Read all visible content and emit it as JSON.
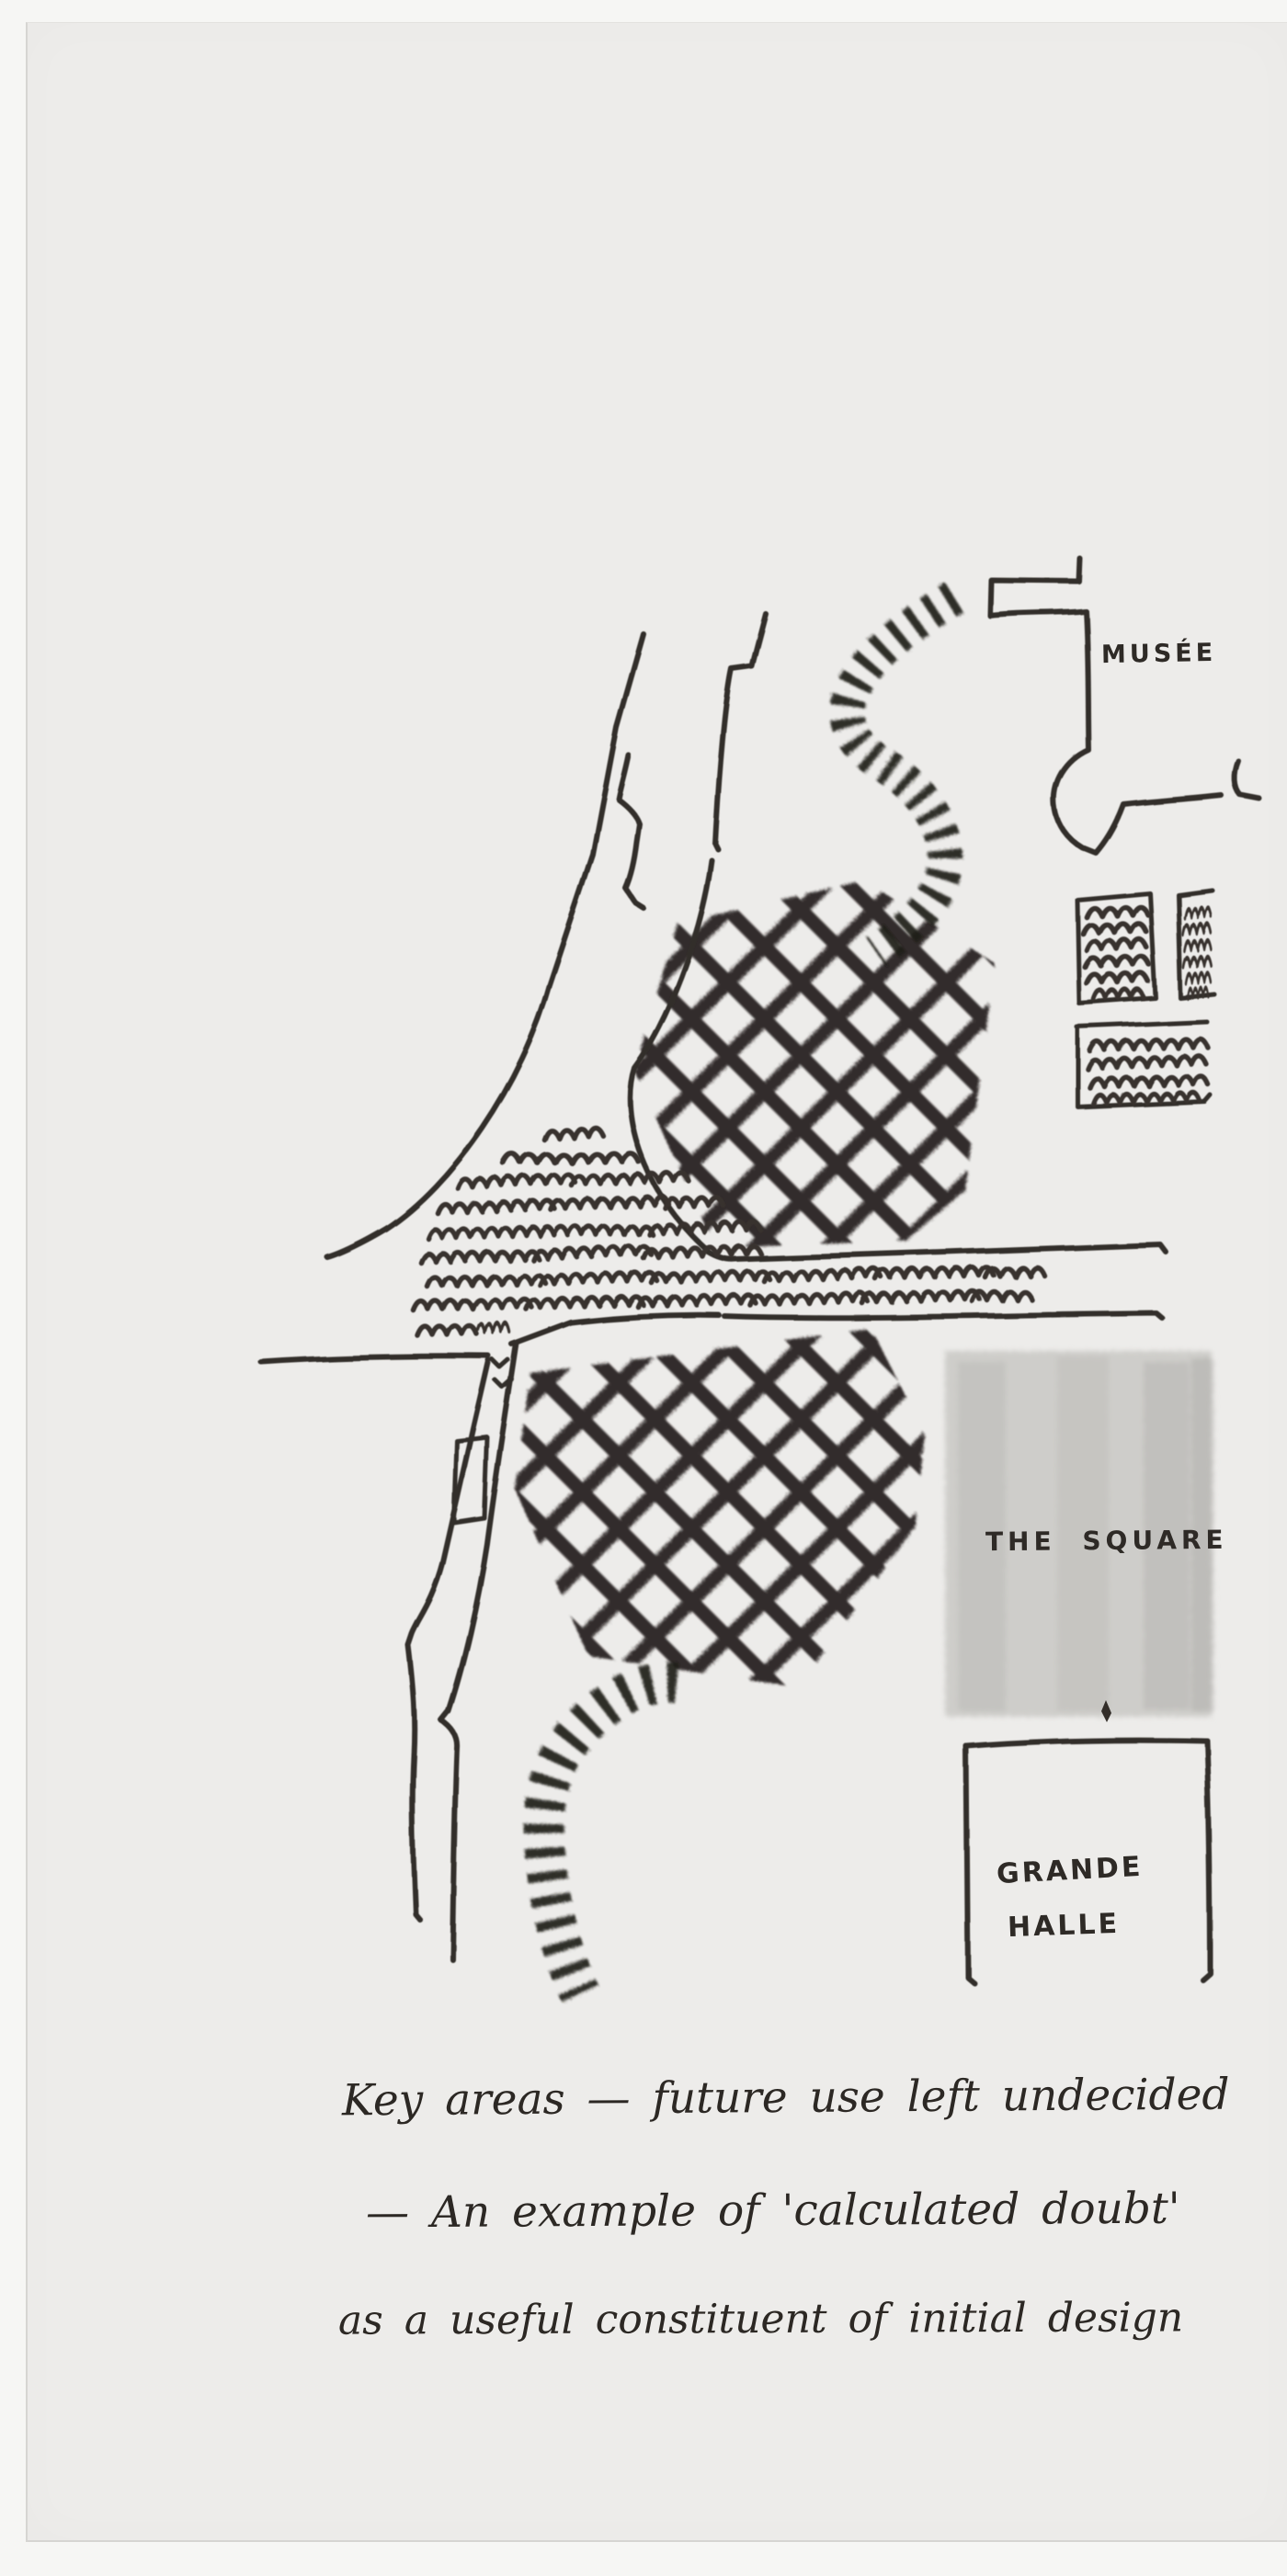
{
  "artwork": {
    "map_labels": {
      "musee": "MUSÉE",
      "the_square": "THE SQUARE",
      "grande_halle_line1": "GRANDE",
      "grande_halle_line2": "HALLE"
    },
    "annotation": {
      "line1": "Key areas — future use left undecided",
      "line2": "— An example of 'calculated doubt'",
      "line3": "as a useful constituent of initial design"
    },
    "colors": {
      "ink": "#332e29",
      "charcoal": "#1d1b19",
      "pencil_gray": "#c7c5c2",
      "paper": "#edecea",
      "backdrop": "#f6f6f4"
    }
  }
}
